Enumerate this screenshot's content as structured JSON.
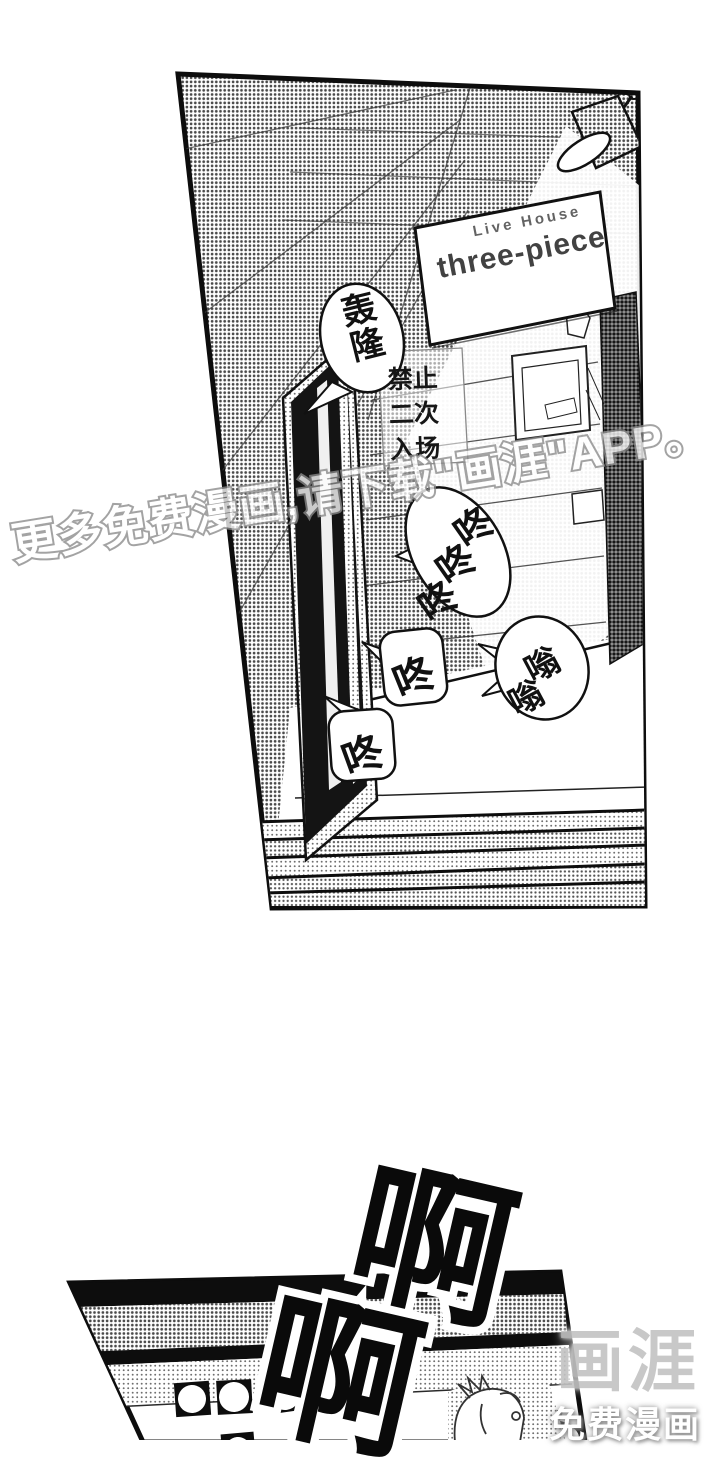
{
  "page": {
    "panel_hallway": {
      "sign_board": {
        "line1": "Live House",
        "line2": "three-piece"
      },
      "wall_sign": {
        "rows": [
          "禁止",
          "二次",
          "入场"
        ]
      },
      "bubbles": {
        "rumble": "轰隆",
        "knock_triple": [
          "咚",
          "咚",
          "咚"
        ],
        "knock_mid": "咚",
        "buzz": [
          "嗡",
          "嗡"
        ],
        "knock_low": "咚"
      }
    },
    "panel_stage": {
      "scream": [
        "啊",
        "啊"
      ]
    },
    "watermark": {
      "text": "更多免费漫画,请下载\"画涯\"APP。"
    },
    "logo": {
      "brand": "画涯",
      "tagline": "免费漫画"
    },
    "colors": {
      "ink": "#111111",
      "paper": "#ffffff",
      "watermark_gray": "#8a8a8a",
      "logo_gray": "#c3c3c3"
    }
  }
}
